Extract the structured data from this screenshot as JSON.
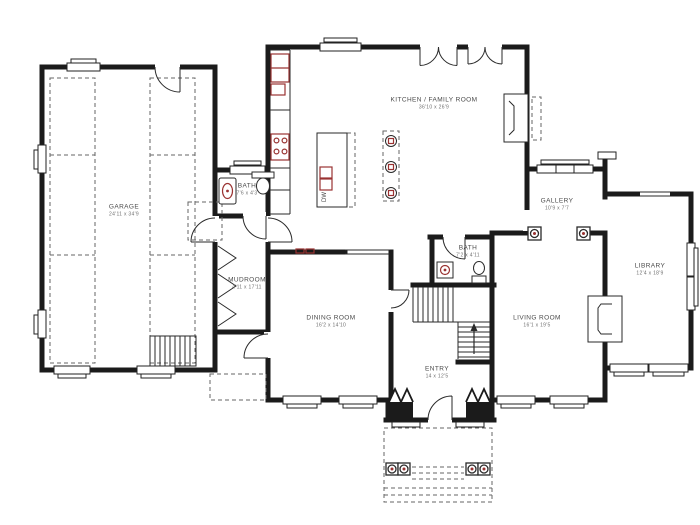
{
  "meta": {
    "drawing_type": "residential first-floor plan",
    "style": "black line architectural plan with red fixture accents"
  },
  "colors": {
    "wall": "#1b1b1b",
    "thin_line": "#2a2a2a",
    "dashed_line": "#666666",
    "accent_red": "#9a3332",
    "text": "#4a4a4a",
    "background": "#ffffff"
  },
  "rooms": [
    {
      "id": "garage",
      "name": "GARAGE",
      "dims": "24'11 x 34'9"
    },
    {
      "id": "bath-garage",
      "name": "BATH",
      "dims": "7'6 x 4'3"
    },
    {
      "id": "kitchen",
      "name": "KITCHEN / FAMILY ROOM",
      "dims": "36'10 x 26'9"
    },
    {
      "id": "mudroom",
      "name": "MUDROOM",
      "dims": "4'11 x 17'11"
    },
    {
      "id": "dining",
      "name": "DINING ROOM",
      "dims": "16'2 x 14'10"
    },
    {
      "id": "bath-main",
      "name": "BATH",
      "dims": "7'2 x 4'11"
    },
    {
      "id": "entry",
      "name": "ENTRY",
      "dims": "14 x 12'5"
    },
    {
      "id": "living",
      "name": "LIVING ROOM",
      "dims": "16'1 x 19'5"
    },
    {
      "id": "gallery",
      "name": "GALLERY",
      "dims": "10'9 x 7'7"
    },
    {
      "id": "library",
      "name": "LIBRARY",
      "dims": "12'4 x 18'9"
    }
  ],
  "fixtures": {
    "dishwasher_label": "DW"
  }
}
